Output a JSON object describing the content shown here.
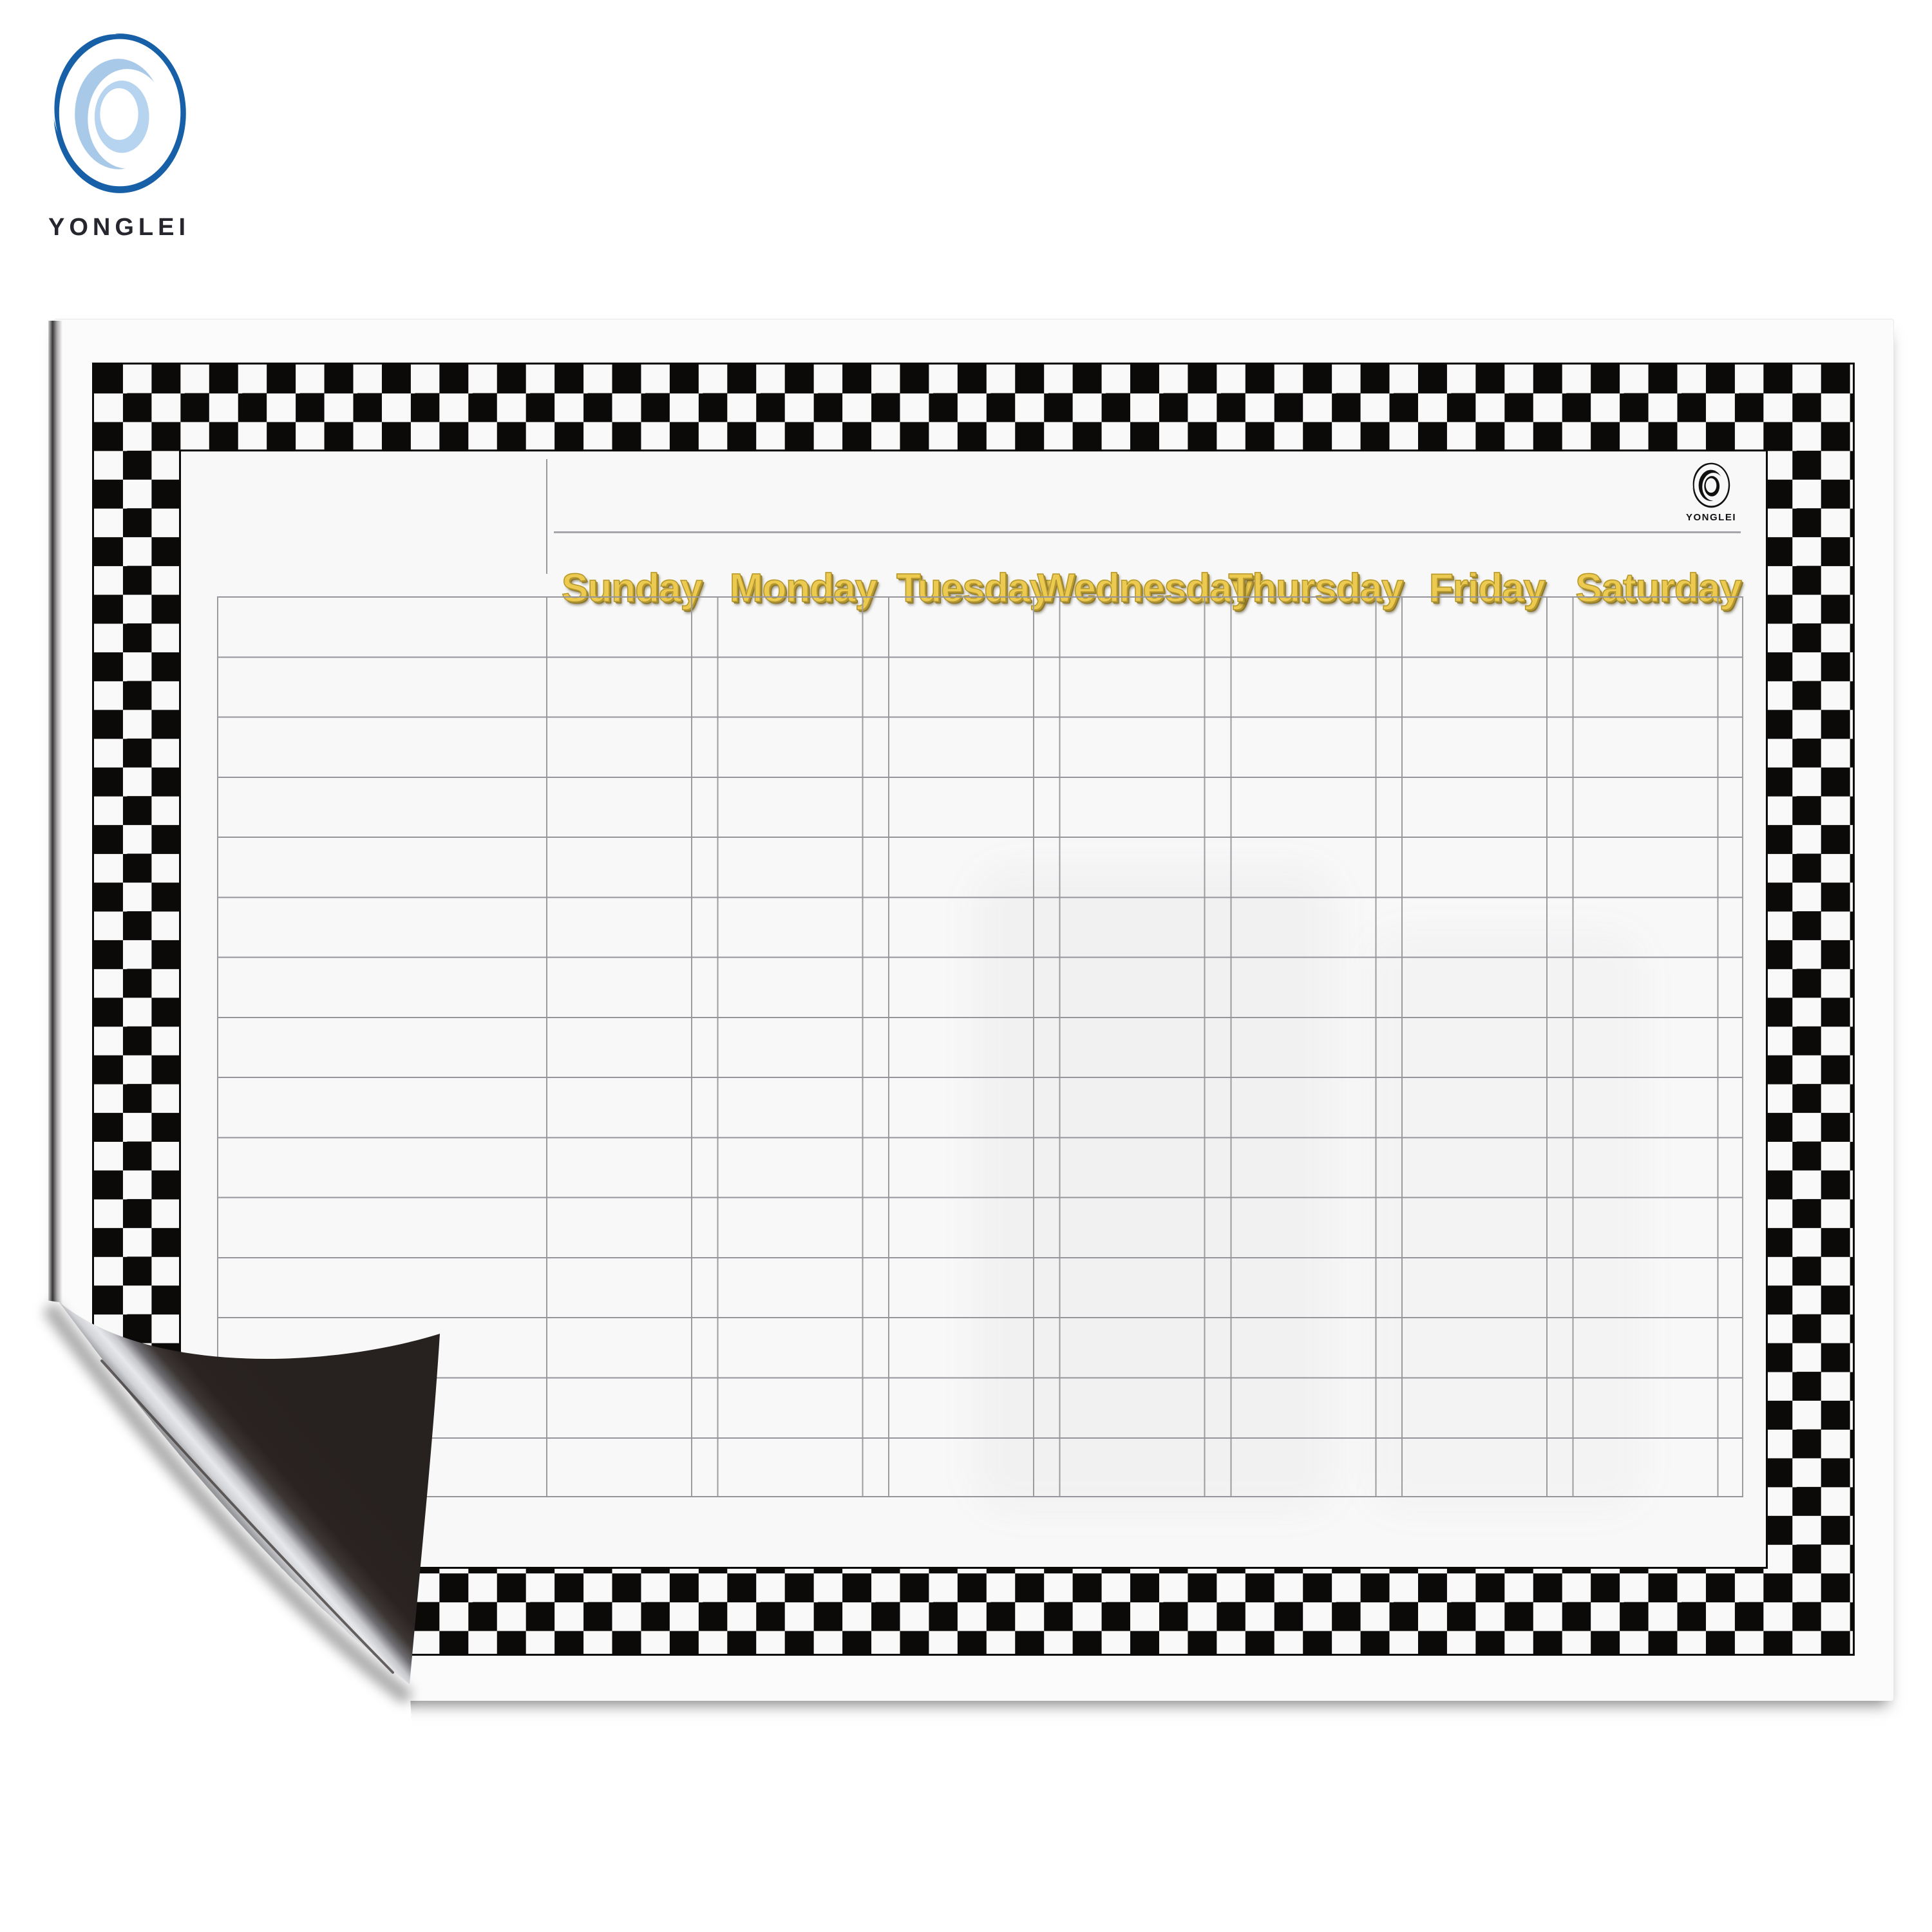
{
  "brand": {
    "name": "YONGLEI"
  },
  "board": {
    "logo_text": "YONGLEI",
    "days": [
      "Sunday",
      "Monday",
      "Tuesday",
      "Wednesday",
      "Thursday",
      "Friday",
      "Saturday"
    ],
    "grid": {
      "rows": 15,
      "day_columns": 7,
      "has_row_label_column": true
    },
    "style": {
      "day_label_gold": "#ecca50",
      "checker_black": "#0b0a09",
      "checker_white": "#f9f9f9",
      "grid_line": "#9c9ca0",
      "magnet_back": "#292322",
      "brand_blue": "#1760a8",
      "brand_blue_light": "#a9c9e9"
    }
  }
}
